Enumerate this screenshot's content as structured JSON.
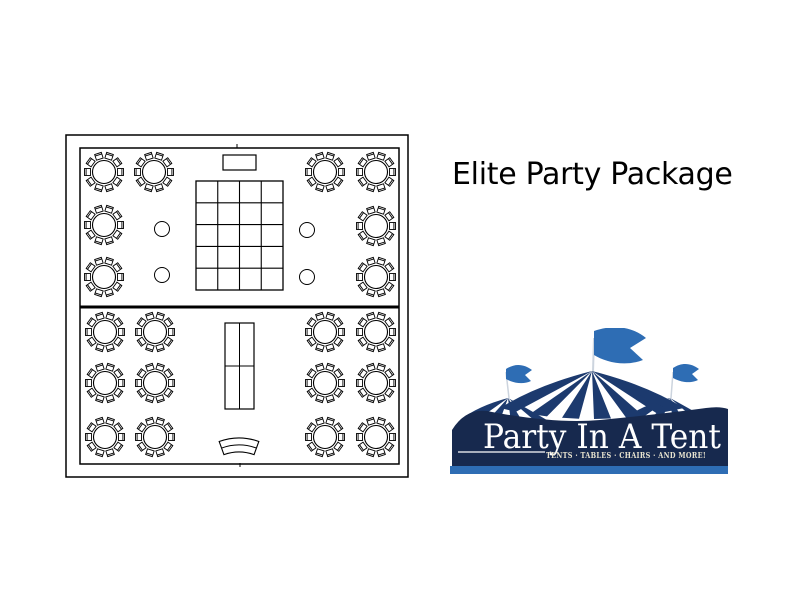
{
  "page": {
    "width": 797,
    "height": 597,
    "background": "#ffffff"
  },
  "title": {
    "text": "Elite Party Package"
  },
  "colors": {
    "background": "#ffffff",
    "title": "#000000",
    "line": "#000000",
    "tent_navy": "#1c3a6e",
    "banner": "#17294e",
    "blue": "#2e6db4",
    "cream": "#e9e4d0",
    "pole": "#ccd4de"
  },
  "floor_plan": {
    "description": "tent floor plan with round guest tables, dance floor, buffet and serpentine table",
    "outer_border": {
      "x": 66,
      "y": 135,
      "w": 342,
      "h": 342
    },
    "inner_border": {
      "x": 80,
      "y": 148,
      "w": 319,
      "h": 316
    },
    "divider_y": 307,
    "round_table": {
      "radius": 11.5,
      "chairs": 10,
      "chair_radius": 16.5
    },
    "round_tables": [
      [
        104,
        172
      ],
      [
        154,
        172
      ],
      [
        325,
        172
      ],
      [
        376,
        172
      ],
      [
        104,
        225
      ],
      [
        376,
        226
      ],
      [
        104,
        277
      ],
      [
        376,
        277
      ],
      [
        105,
        332
      ],
      [
        155,
        332
      ],
      [
        325,
        332
      ],
      [
        376,
        332
      ],
      [
        105,
        383
      ],
      [
        155,
        383
      ],
      [
        325,
        383
      ],
      [
        376,
        383
      ],
      [
        105,
        437
      ],
      [
        155,
        437
      ],
      [
        325,
        437
      ],
      [
        376,
        437
      ]
    ],
    "cocktail_tables": {
      "radius": 7.5,
      "positions": [
        [
          162,
          229
        ],
        [
          162,
          275
        ],
        [
          307,
          230
        ],
        [
          307,
          277
        ]
      ]
    },
    "cake_table": {
      "x": 223,
      "y": 155,
      "w": 33,
      "h": 15
    },
    "dance_floor": {
      "x": 196,
      "y": 181,
      "w": 87,
      "h": 109,
      "cols": 4,
      "rows": 5
    },
    "buffet_table": {
      "x": 225,
      "y": 323,
      "w": 29,
      "h": 86,
      "cols": 2,
      "rows": 2
    },
    "serpentine_table": {
      "cx": 239,
      "cy": 496,
      "r_outer": 58,
      "r_mid": 51,
      "r_inner": 44,
      "half_angle_deg": 20
    },
    "ticks": [
      [
        237,
        144,
        237,
        148
      ],
      [
        240,
        463,
        240,
        467
      ]
    ]
  },
  "logo": {
    "name": "Party In A Tent",
    "tagline": "TENTS · TABLES · CHAIRS · AND MORE!"
  }
}
